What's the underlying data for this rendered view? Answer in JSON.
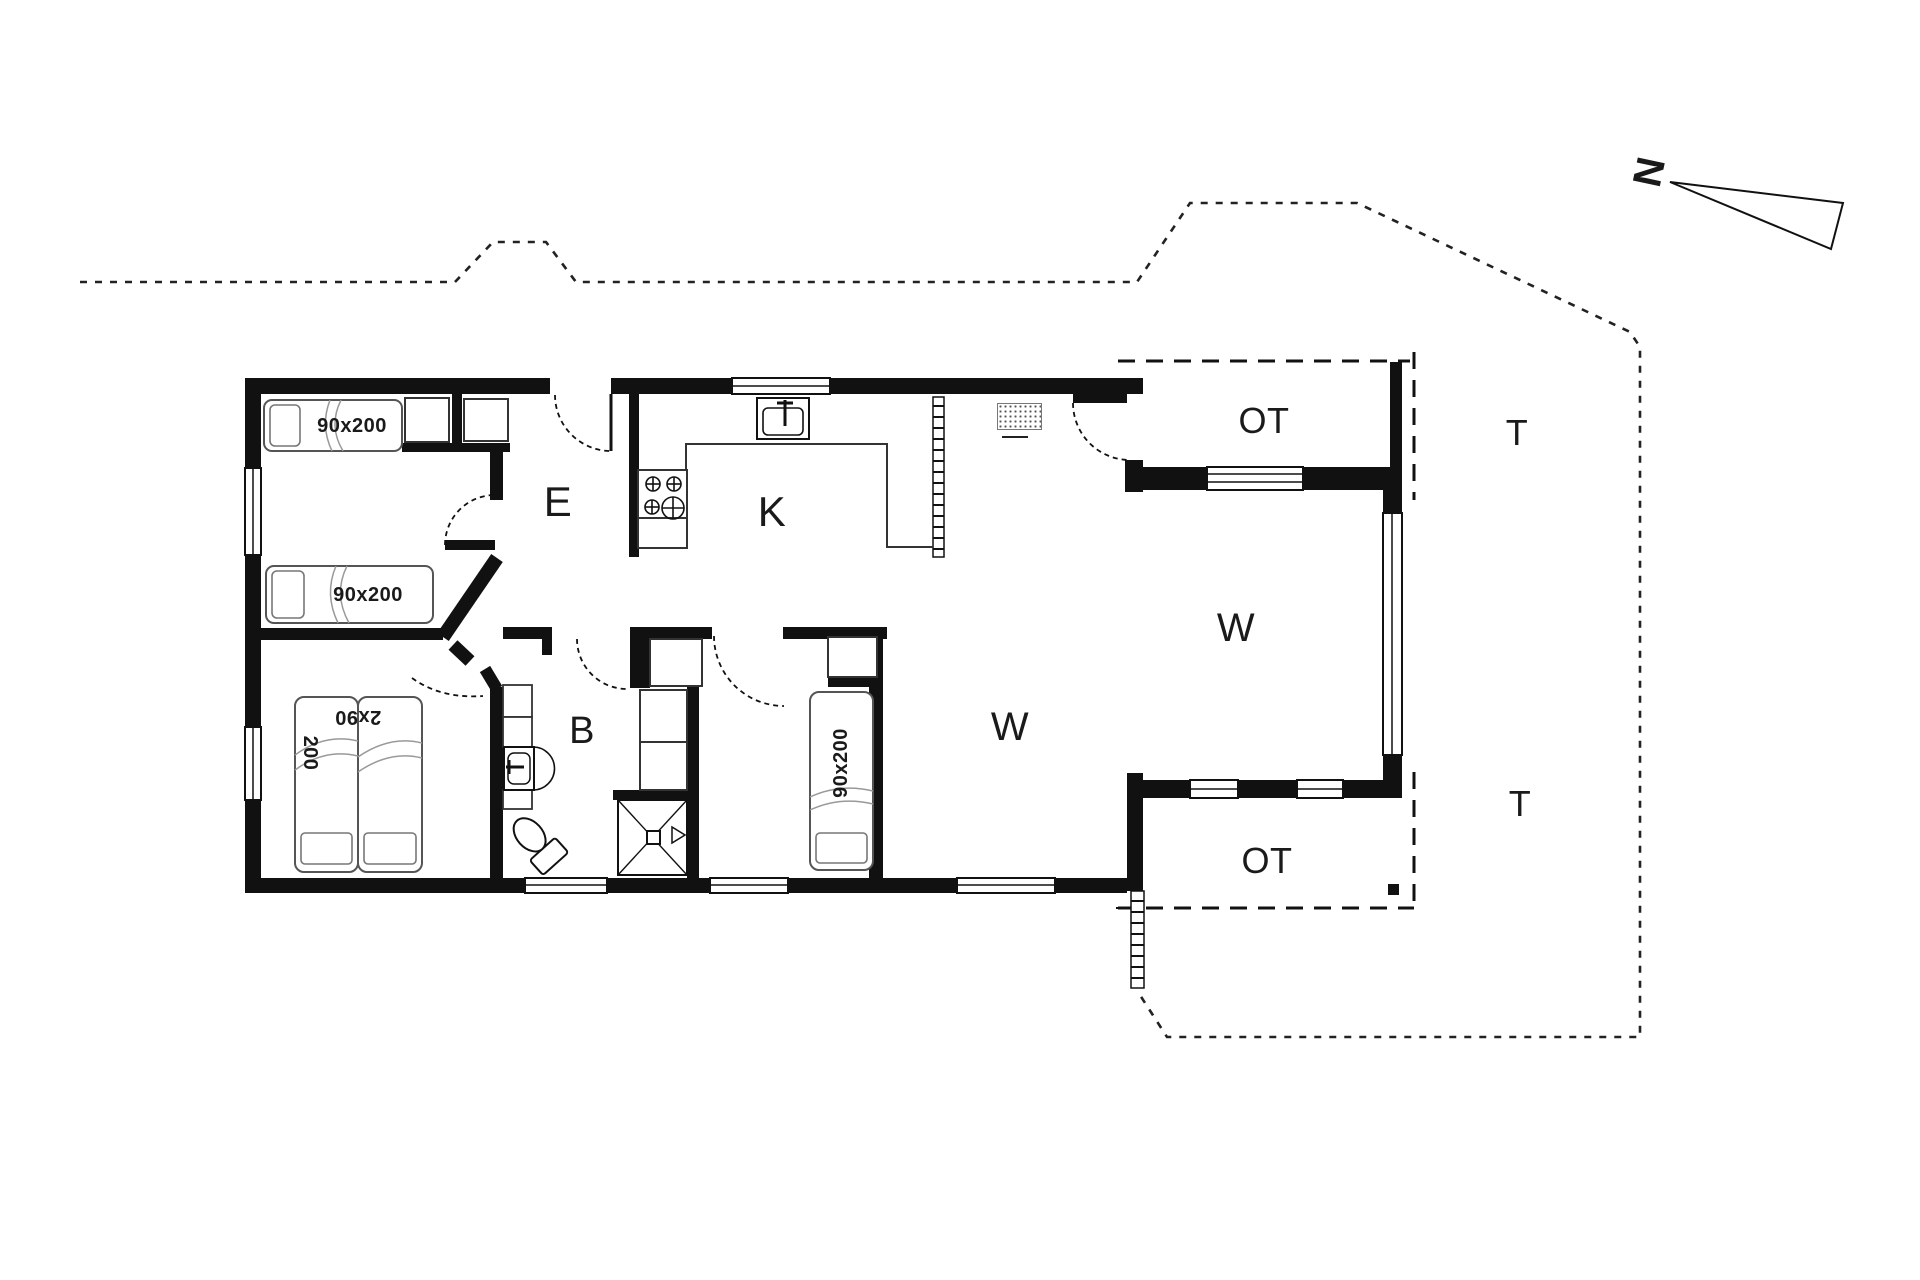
{
  "plan_title": "Holiday house floor plan",
  "north": {
    "label": "N"
  },
  "rooms": {
    "entrance": "E",
    "kitchen": "K",
    "bath": "B",
    "living_small": "W",
    "living_large": "W",
    "covered_terrace_north": "OT",
    "covered_terrace_south": "OT",
    "terrace_north": "T",
    "terrace_south": "T"
  },
  "furniture": {
    "bed_top_room_upper": "90x200",
    "bed_top_room_lower": "90x200",
    "double_bed_width": "2x90",
    "double_bed_length": "200",
    "bed_middle_room": "90x200"
  },
  "colors": {
    "wall": "#111111",
    "thin_line": "#333333",
    "furniture_stroke": "#555555",
    "background": "#ffffff"
  }
}
